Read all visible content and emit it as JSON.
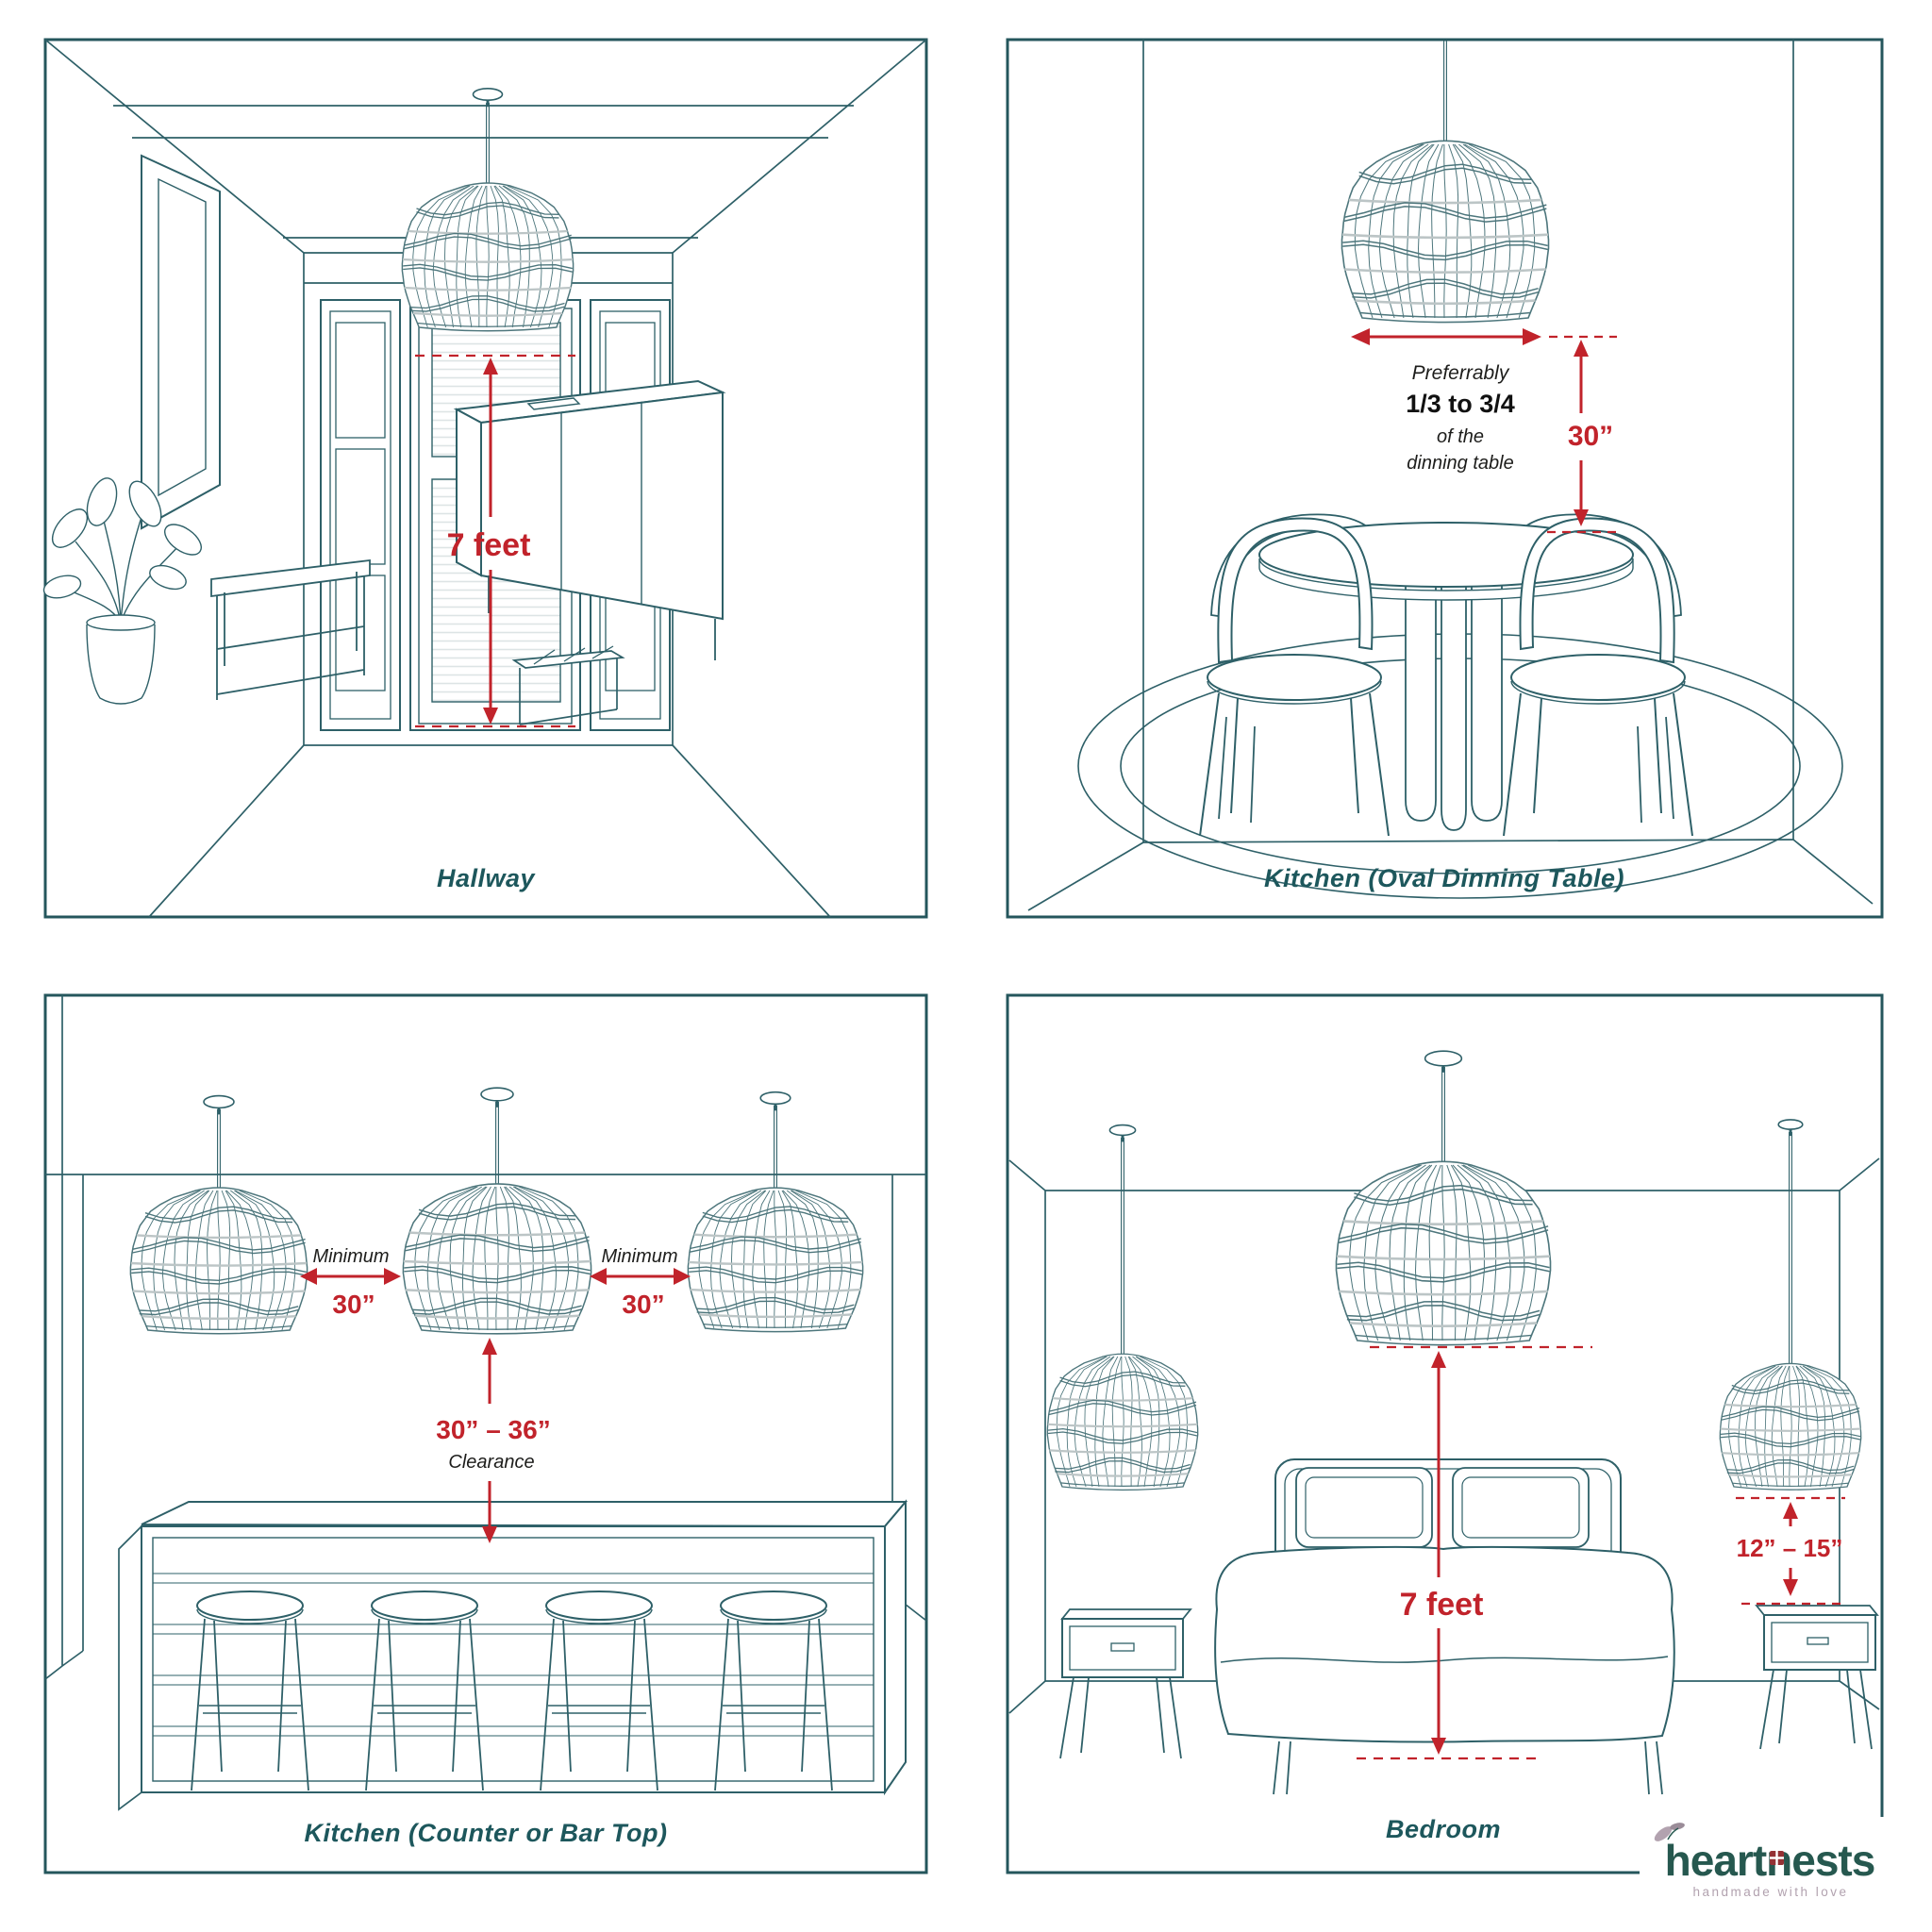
{
  "colors": {
    "line_teal": "#2e6068",
    "wicker_teal": "#4d767c",
    "ring_gray": "#bcc5c6",
    "accent_red": "#c1232b",
    "caption_teal": "#1d575c",
    "logo_teal": "#26584f",
    "logo_mauve": "#b2a2af",
    "logo_window_red": "#943134"
  },
  "panel_hallway": {
    "caption": "Hallway",
    "measure": "7 feet"
  },
  "panel_kitchen_table": {
    "caption": "Kitchen (Oval Dinning Table)",
    "pref_line1": "Preferrably",
    "pref_line2": "1/3 to 3/4",
    "pref_line3": "of the",
    "pref_line4": "dinning table",
    "drop": "30”"
  },
  "panel_kitchen_counter": {
    "caption": "Kitchen (Counter or Bar Top)",
    "spacing1_label": "Minimum",
    "spacing1_value": "30”",
    "spacing2_label": "Minimum",
    "spacing2_value": "30”",
    "clearance_value": "30” – 36”",
    "clearance_label": "Clearance"
  },
  "panel_bedroom": {
    "caption": "Bedroom",
    "center_drop": "7 feet",
    "side_drop": "12” – 15”"
  },
  "logo": {
    "wordmark": "heartnests",
    "tagline": "handmade with love"
  }
}
